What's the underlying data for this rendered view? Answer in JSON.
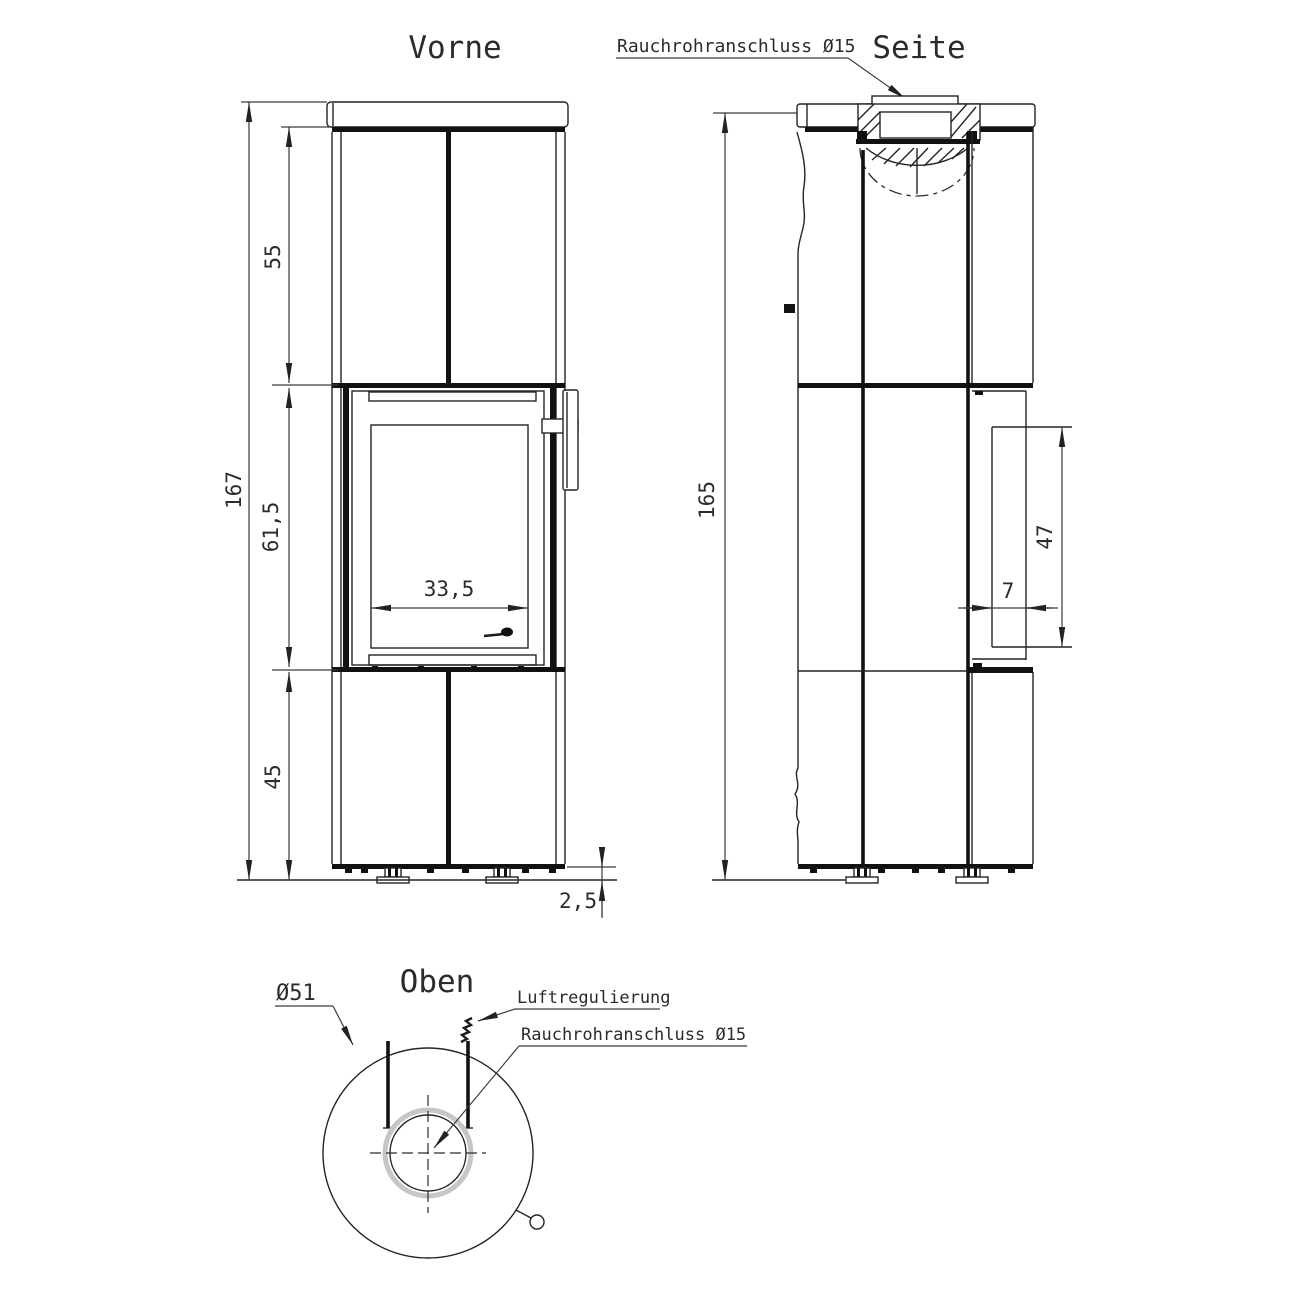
{
  "front": {
    "title": "Vorne",
    "dims": {
      "total_height": "167",
      "upper_section": "55",
      "door_section": "61,5",
      "lower_section": "45",
      "glass_width": "33,5",
      "foot_height": "2,5"
    }
  },
  "side": {
    "title": "Seite",
    "flue_label": "Rauchrohranschluss Ø15",
    "dims": {
      "height": "165",
      "handle_length": "47",
      "door_depth": "7"
    }
  },
  "top": {
    "title": "Oben",
    "diameter_label": "Ø51",
    "air_label": "Luftregulierung",
    "flue_label": "Rauchrohranschluss Ø15"
  }
}
